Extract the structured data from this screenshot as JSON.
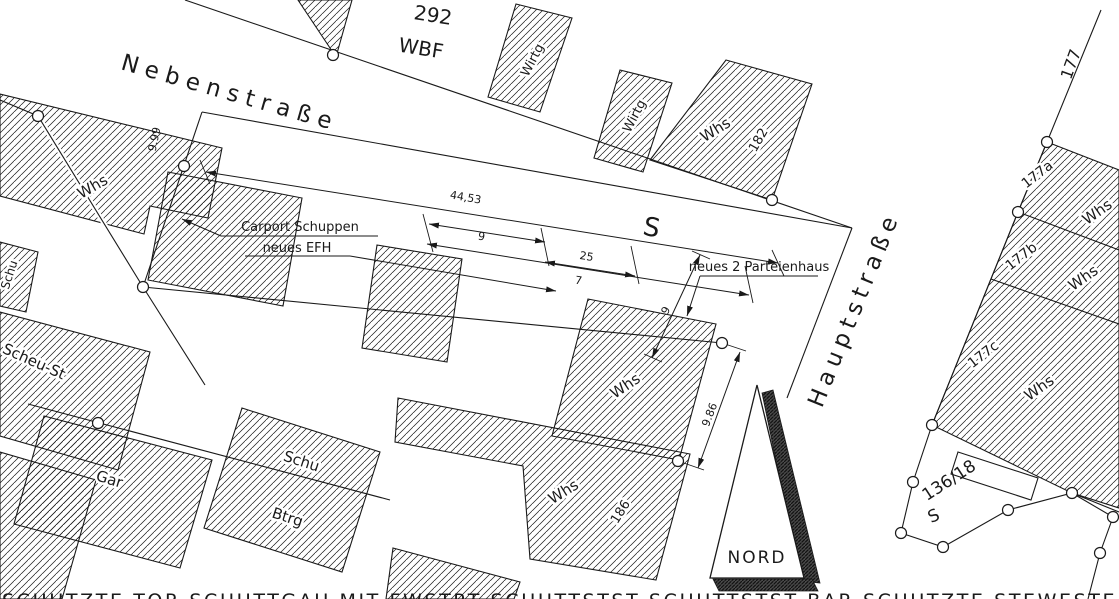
{
  "streets": {
    "nebenstrasse": "Nebenstraße",
    "hauptstrasse": "Hauptstraße",
    "scheu_st": "Scheu-St"
  },
  "parcels": {
    "p292": "292",
    "wbf": "WBF",
    "s_road": "S",
    "s_lower": "S",
    "n177": "177",
    "n177a": "177a",
    "n177b": "177b",
    "n177c": "177c",
    "n136_18": "136/18",
    "n182": "182",
    "n186": "186"
  },
  "buildings": {
    "whs": "Whs",
    "wirtg": "Wirtg",
    "schu": "Schu",
    "btrg": "Btrg",
    "gar": "Gar"
  },
  "annotations": {
    "carport": "Carport Schuppen",
    "neues_efh": "neues EFH",
    "neues_parteienhaus": "neues 2 Parteienhaus",
    "nord": "NORD",
    "bottom_clipped": "SCHUTZTE TOR SCHUTTGAU MIT FWSTRT SCHUTTSTST SCHUTTSTST BAR SCHUTZTE STEWESTE"
  },
  "dimensions": {
    "d44_53": "44,53",
    "d9_99": "9.99",
    "d9_86": "9.86",
    "d9": "9",
    "d25": "25",
    "d7": "7"
  },
  "colors": {
    "ink": "#1a1a1a",
    "paper": "#ffffff"
  }
}
